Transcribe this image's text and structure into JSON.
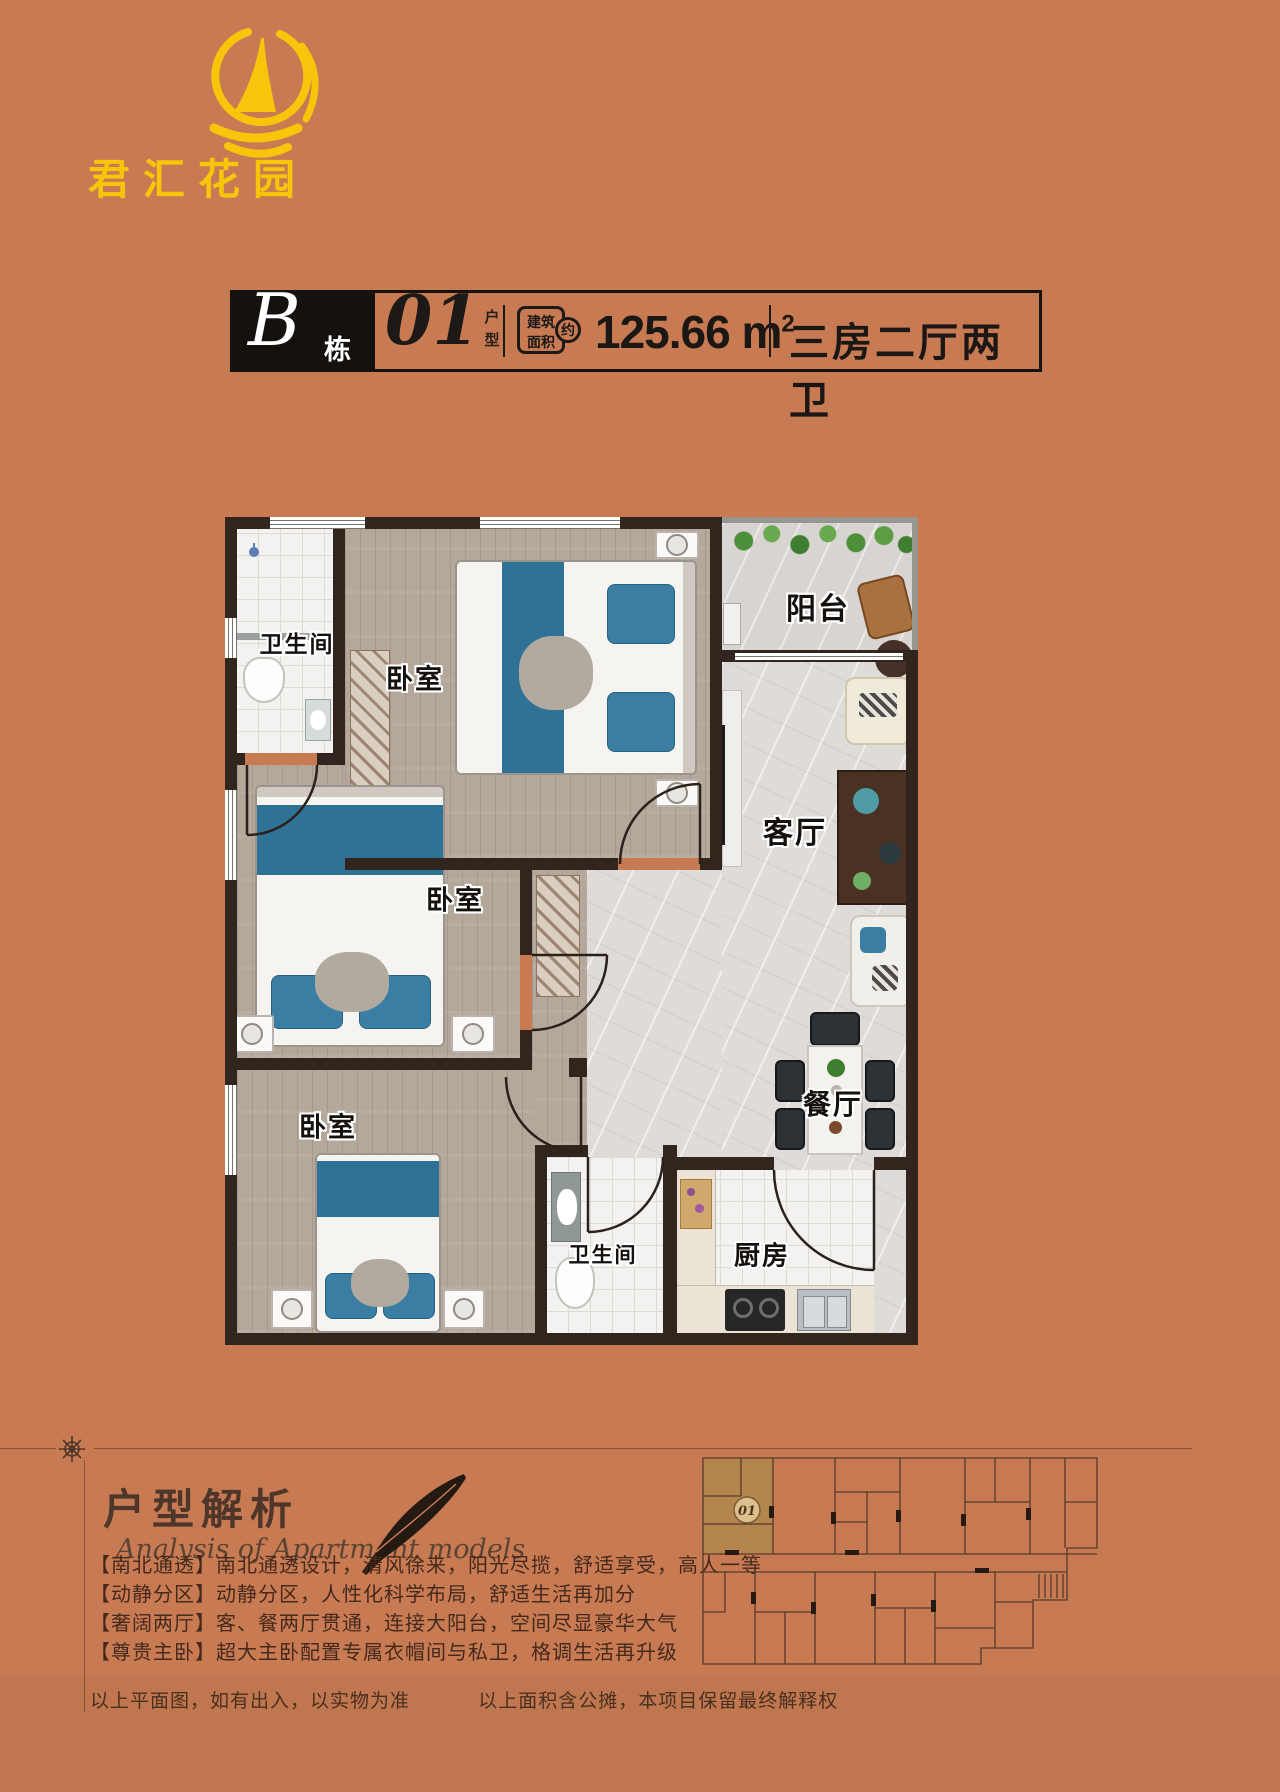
{
  "page": {
    "bg_color": "#c87b53",
    "accent_yellow": "#f8c50a",
    "wall_color": "#32251e"
  },
  "logo": {
    "name": "君汇花园",
    "icon": "sailboat-icon"
  },
  "title_bar": {
    "block_letter": "B",
    "block_suffix": "栋",
    "unit_number": "01",
    "unit_suffix": "户型",
    "area_badge_line1": "建筑",
    "area_badge_line2": "面积",
    "area_badge_circle": "约",
    "area_value": "125.66",
    "area_unit": "m",
    "area_sup": "2",
    "layout_text": "三房二厅两卫"
  },
  "plan": {
    "rooms": [
      {
        "id": "bathroom-1",
        "label": "卫生间"
      },
      {
        "id": "bedroom-1",
        "label": "卧室"
      },
      {
        "id": "balcony",
        "label": "阳台"
      },
      {
        "id": "living-room",
        "label": "客厅"
      },
      {
        "id": "bedroom-2",
        "label": "卧室"
      },
      {
        "id": "dining-room",
        "label": "餐厅"
      },
      {
        "id": "bedroom-3",
        "label": "卧室"
      },
      {
        "id": "bathroom-2",
        "label": "卫生间"
      },
      {
        "id": "kitchen",
        "label": "厨房"
      }
    ]
  },
  "analysis": {
    "title": "户型解析",
    "subtitle": "Analysis of Apartment models",
    "features": [
      "【南北通透】南北通透设计，清风徐来，阳光尽揽，舒适享受，高人一等",
      "【动静分区】动静分区，人性化科学布局，舒适生活再加分",
      "【奢阔两厅】客、餐两厅贯通，连接大阳台，空间尽显豪华大气",
      "【尊贵主卧】超大主卧配置专属衣帽间与私卫，格调生活再升级"
    ]
  },
  "floor_plate": {
    "unit_number": "01"
  },
  "disclaimer": {
    "left": "以上平面图，如有出入，以实物为准",
    "right": "以上面积含公摊，本项目保留最终解释权"
  }
}
